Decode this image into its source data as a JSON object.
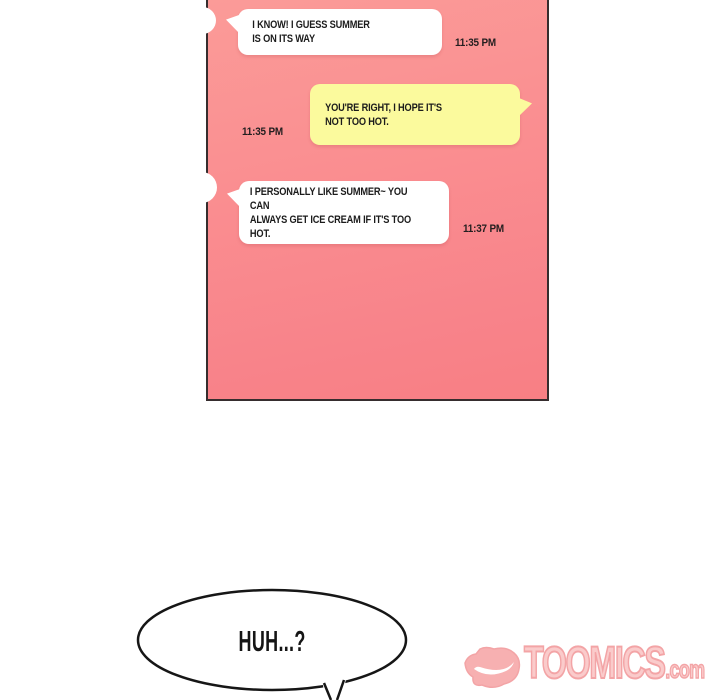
{
  "chat": {
    "messages": [
      {
        "side": "left",
        "text": "I KNOW! I GUESS SUMMER\nIS ON ITS WAY",
        "time": "11:35 PM"
      },
      {
        "side": "right",
        "text": "YOU'RE RIGHT, I HOPE IT'S\nNOT TOO HOT.",
        "time": "11:35 PM"
      },
      {
        "side": "left",
        "text": "I PERSONALLY LIKE SUMMER~ YOU CAN\nALWAYS GET ICE CREAM IF IT'S TOO HOT.",
        "time": "11:37 PM"
      }
    ],
    "colors": {
      "screen_top": "#fb9b98",
      "screen_bottom": "#f87f84",
      "screen_border": "#362d2e",
      "left_bubble": "#ffffff",
      "right_bubble": "#fbfa9d",
      "message_text": "#1b1b1b"
    }
  },
  "speech_bubble": {
    "text": "HUH...?"
  },
  "watermark": {
    "brand": "TOOMICS",
    "suffix": ".com",
    "color": "#f19597",
    "icon": "toomics-devil-icon"
  }
}
